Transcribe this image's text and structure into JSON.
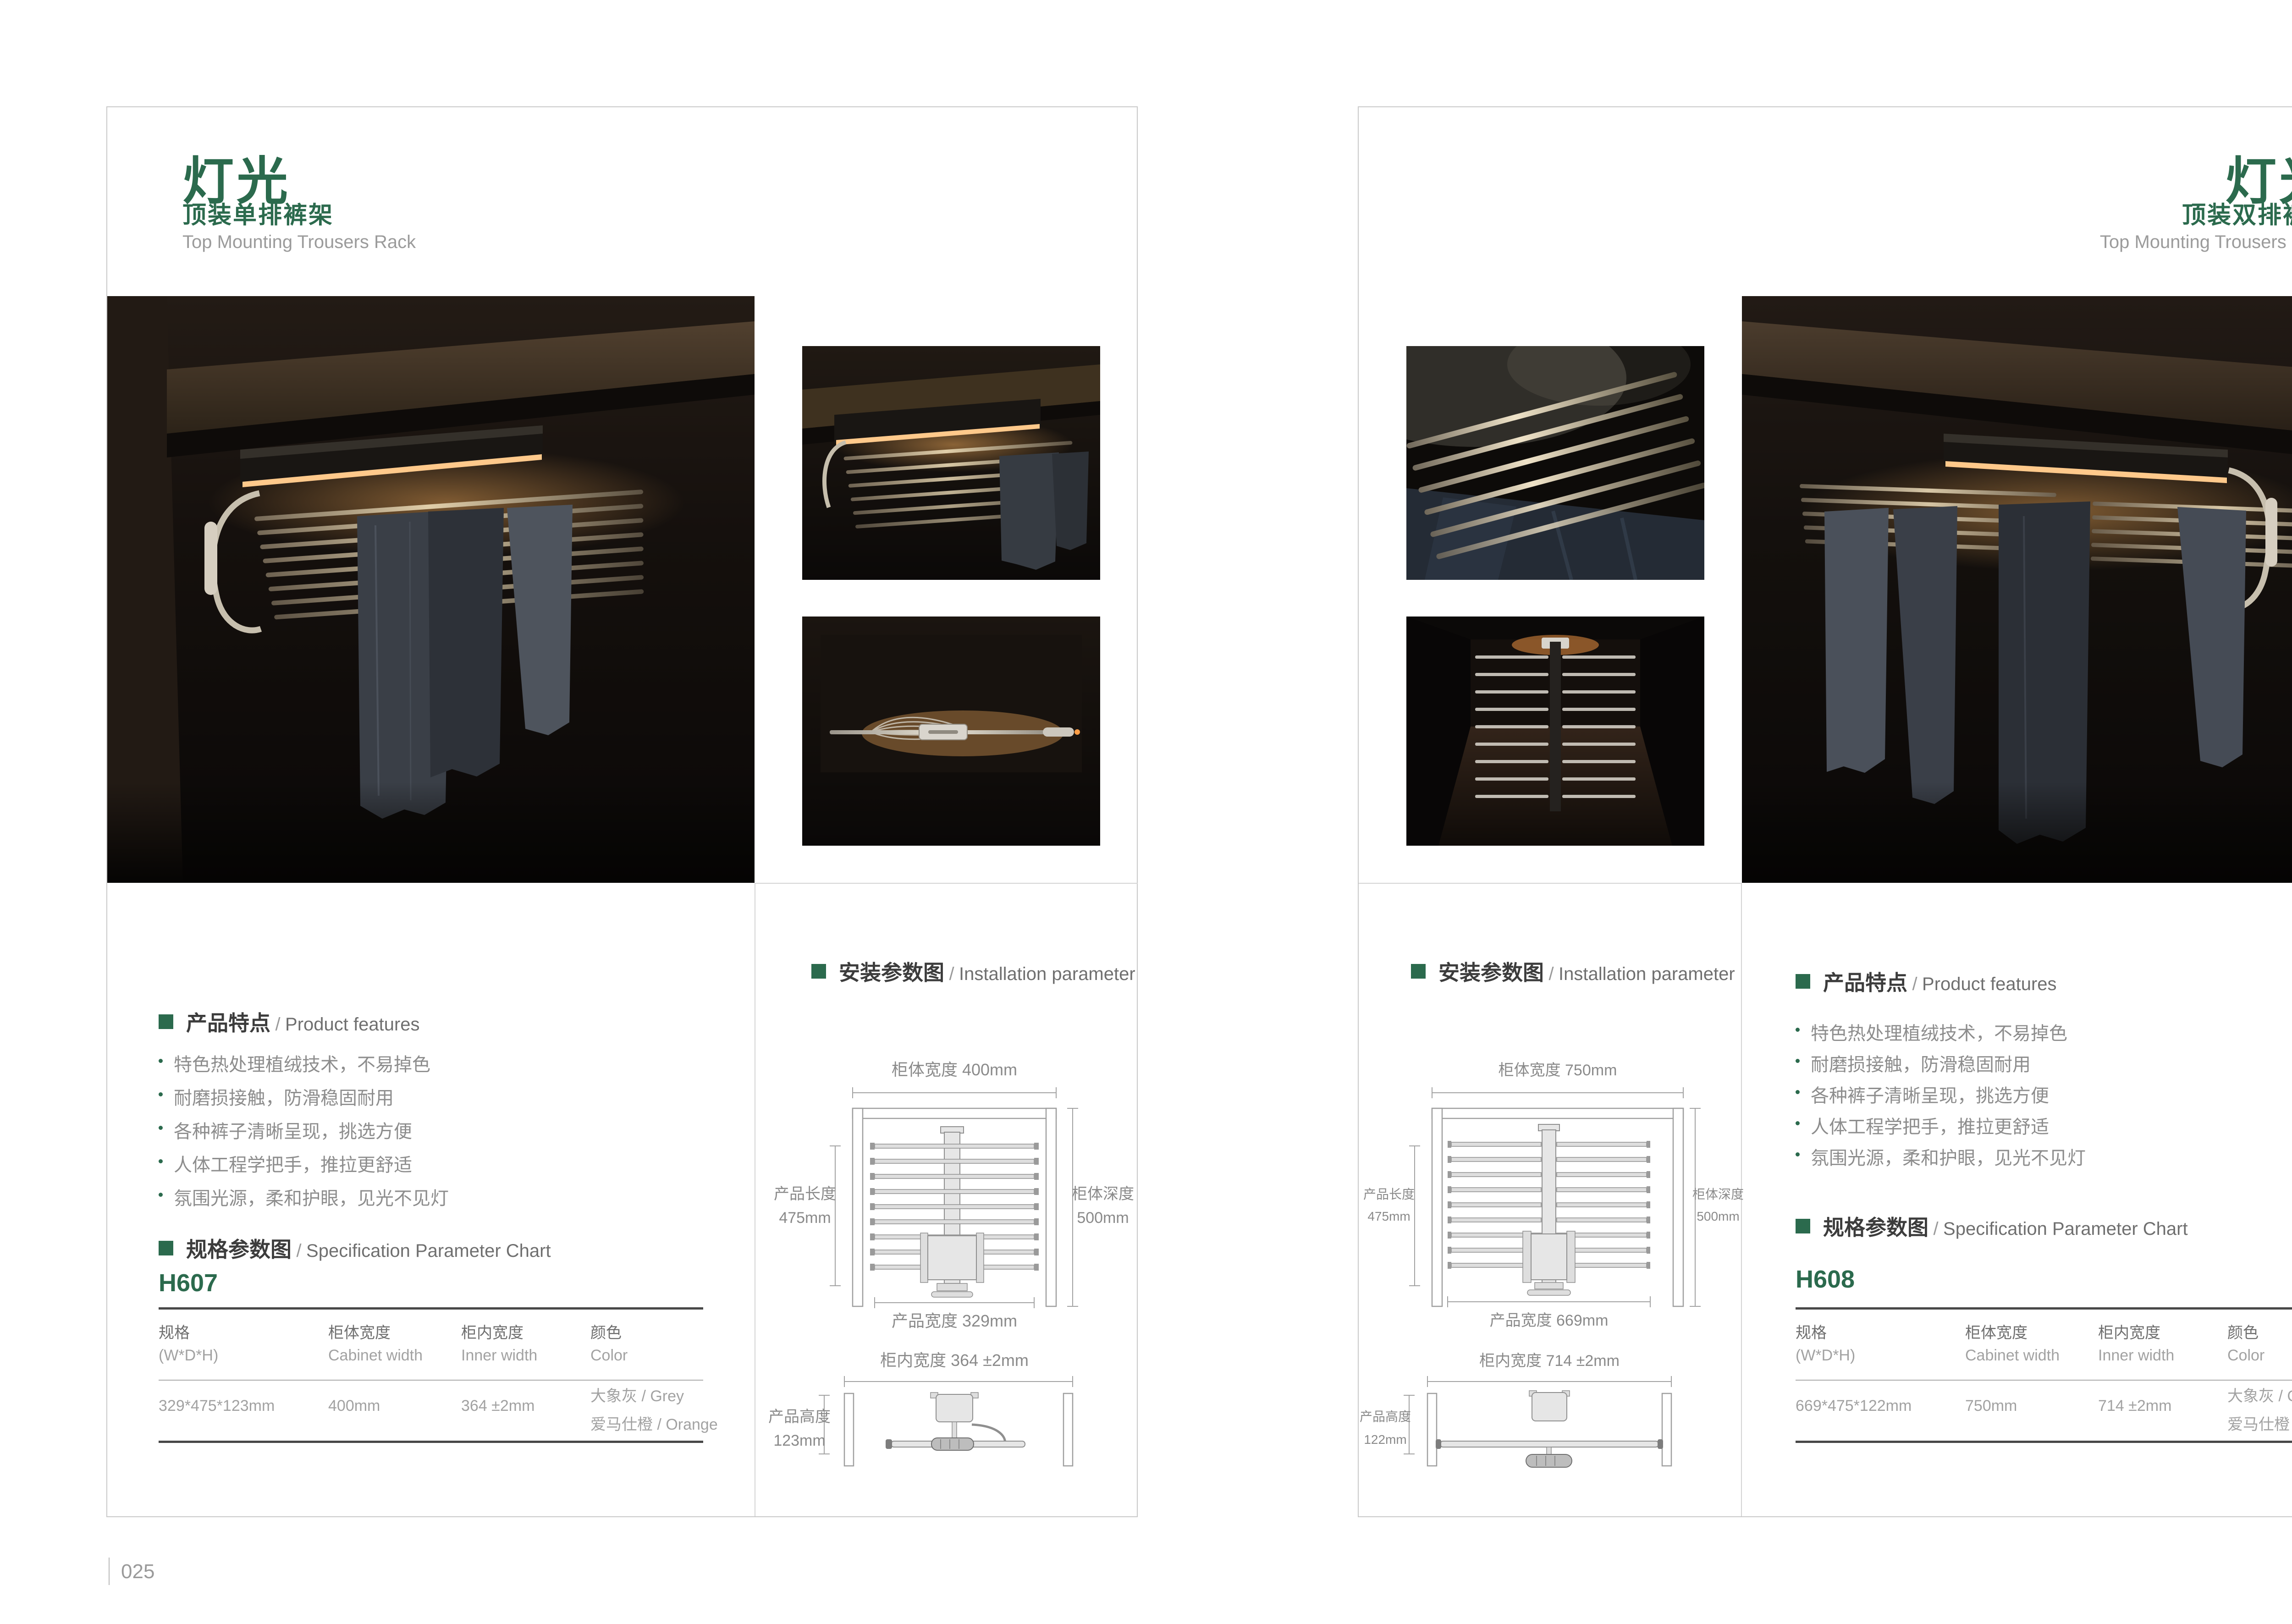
{
  "ui": {
    "sep": "/"
  },
  "colors": {
    "accent_green": "#2b6a4d",
    "glow_amber": "#ffb45e",
    "card_border": "#c9c9c9"
  },
  "pages": {
    "left": {
      "page_number": "025",
      "header": {
        "title": "灯光",
        "subtitle": "顶装单排裤架",
        "subtitle_en": "Top Mounting Trousers Rack"
      },
      "features": {
        "label": "产品特点",
        "label_en": "Product features",
        "items": [
          "特色热处理植绒技术，不易掉色",
          "耐磨损接触，防滑稳固耐用",
          "各种裤子清晰呈现，挑选方便",
          "人体工程学把手，推拉更舒适",
          "氛围光源，柔和护眼，见光不见灯"
        ]
      },
      "spec": {
        "label": "规格参数图",
        "label_en": "Specification Parameter Chart",
        "model": "H607",
        "columns": [
          {
            "cn": "规格",
            "en": "(W*D*H)"
          },
          {
            "cn": "柜体宽度",
            "en": "Cabinet width"
          },
          {
            "cn": "柜内宽度",
            "en": "Inner width"
          },
          {
            "cn": "颜色",
            "en": "Color"
          }
        ],
        "row": {
          "size": "329*475*123mm",
          "cabinet_width": "400mm",
          "inner_width": "364 ±2mm",
          "color1": "大象灰 / Grey",
          "color2": "爱马仕橙 / Orange"
        }
      },
      "installation": {
        "label": "安装参数图",
        "label_en": "Installation parameter",
        "plan": {
          "top": "柜体宽度 400mm",
          "left1": "产品长度",
          "left2": "475mm",
          "right1": "柜体深度",
          "right2": "500mm",
          "bottom": "产品宽度 329mm"
        },
        "front": {
          "top": "柜内宽度 364 ±2mm",
          "left1": "产品高度",
          "left2": "123mm"
        }
      }
    },
    "right": {
      "page_number": "026",
      "header": {
        "title": "灯光",
        "subtitle": "顶装双排裤架",
        "subtitle_en": "Top Mounting Trousers Rack"
      },
      "features": {
        "label": "产品特点",
        "label_en": "Product features",
        "items": [
          "特色热处理植绒技术，不易掉色",
          "耐磨损接触，防滑稳固耐用",
          "各种裤子清晰呈现，挑选方便",
          "人体工程学把手，推拉更舒适",
          "氛围光源，柔和护眼，见光不见灯"
        ]
      },
      "spec": {
        "label": "规格参数图",
        "label_en": "Specification Parameter Chart",
        "model": "H608",
        "columns": [
          {
            "cn": "规格",
            "en": "(W*D*H)"
          },
          {
            "cn": "柜体宽度",
            "en": "Cabinet width"
          },
          {
            "cn": "柜内宽度",
            "en": "Inner width"
          },
          {
            "cn": "颜色",
            "en": "Color"
          }
        ],
        "row": {
          "size": "669*475*122mm",
          "cabinet_width": "750mm",
          "inner_width": "714 ±2mm",
          "color1": "大象灰 / Grey",
          "color2": "爱马仕橙 / Orange"
        }
      },
      "installation": {
        "label": "安装参数图",
        "label_en": "Installation parameter",
        "plan": {
          "top": "柜体宽度 750mm",
          "left1": "产品长度",
          "left2": "475mm",
          "right1": "柜体深度",
          "right2": "500mm",
          "bottom": "产品宽度 669mm"
        },
        "front": {
          "top": "柜内宽度 714 ±2mm",
          "left1": "产品高度",
          "left2": "122mm"
        }
      }
    }
  }
}
